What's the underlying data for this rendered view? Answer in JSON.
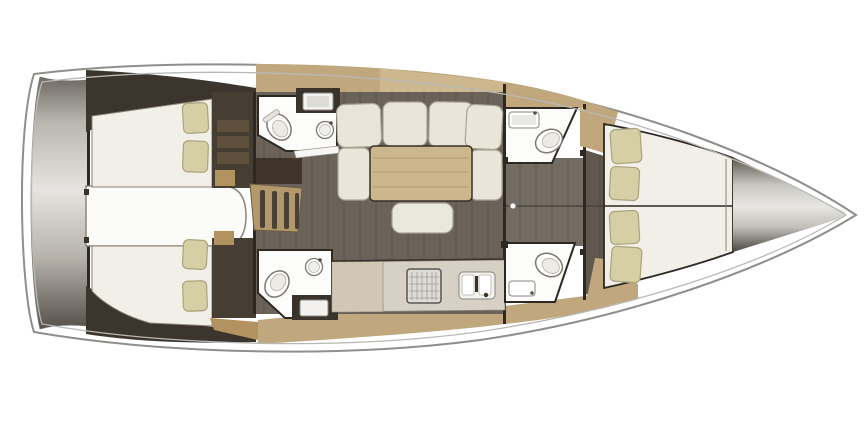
{
  "title": "Sailing yacht interior floor plan, top view, bow pointing right",
  "palette": {
    "background": "#ffffff",
    "hull_line": "#8e8e8a",
    "gunwale_line": "#b8b8b4",
    "deck_wood": "#c0a77d",
    "deck_wood_light": "#d0bc96",
    "stair_wood": "#b3986c",
    "locker_tan": "#b2925f",
    "floor_dark": "#6b635a",
    "floor_passage": "#746c62",
    "wall_dark": "#3c352d",
    "bulkhead": "#2d2822",
    "wardrobe": "#463d33",
    "mattress": "#f1efe7",
    "pillow": "#d6cfa6",
    "cushion": "#e9e5d8",
    "table_wood": "#ccb78c",
    "counter": "#d6d0c5",
    "fixture_white": "#fcfcfa",
    "appliance_steel": "#dedcd6",
    "hood_brown": "#41342a"
  },
  "layout": {
    "orientation": "bow-right",
    "sections": [
      {
        "id": "swim-platform",
        "name": "stern transom / swim platform"
      },
      {
        "id": "aft-cabin-port",
        "name": "aft double cabin port",
        "fixtures": [
          "double-berth",
          "pillow",
          "pillow",
          "wardrobe"
        ]
      },
      {
        "id": "aft-cabin-starboard",
        "name": "aft double cabin starboard",
        "fixtures": [
          "double-berth",
          "pillow",
          "pillow",
          "wardrobe"
        ]
      },
      {
        "id": "engine-compartment",
        "name": "engine compartment under cockpit"
      },
      {
        "id": "companionway",
        "name": "companionway steps",
        "fixtures": [
          "step",
          "step",
          "step",
          "step"
        ]
      },
      {
        "id": "aft-head-port",
        "name": "aft head port",
        "fixtures": [
          "toilet",
          "washbasin",
          "vanity",
          "door"
        ]
      },
      {
        "id": "aft-head-starboard",
        "name": "aft head starboard",
        "fixtures": [
          "toilet",
          "washbasin",
          "vanity"
        ]
      },
      {
        "id": "saloon",
        "name": "saloon",
        "fixtures": [
          "u-shaped-settee",
          "dining-table",
          "ottoman"
        ]
      },
      {
        "id": "galley",
        "name": "galley starboard",
        "fixtures": [
          "stove",
          "double-sink",
          "counter"
        ]
      },
      {
        "id": "fwd-head-port",
        "name": "forward head port",
        "fixtures": [
          "washbasin",
          "toilet"
        ]
      },
      {
        "id": "fwd-head-starboard",
        "name": "forward head starboard",
        "fixtures": [
          "toilet",
          "washbasin"
        ]
      },
      {
        "id": "passage",
        "name": "central passage",
        "fixtures": [
          "door-knob"
        ]
      },
      {
        "id": "forward-cabin",
        "name": "forward owners cabin",
        "fixtures": [
          "v-berth",
          "pillow",
          "pillow",
          "pillow",
          "pillow",
          "corner-locker",
          "corner-locker"
        ]
      },
      {
        "id": "bow-locker",
        "name": "bow anchor locker"
      }
    ]
  }
}
